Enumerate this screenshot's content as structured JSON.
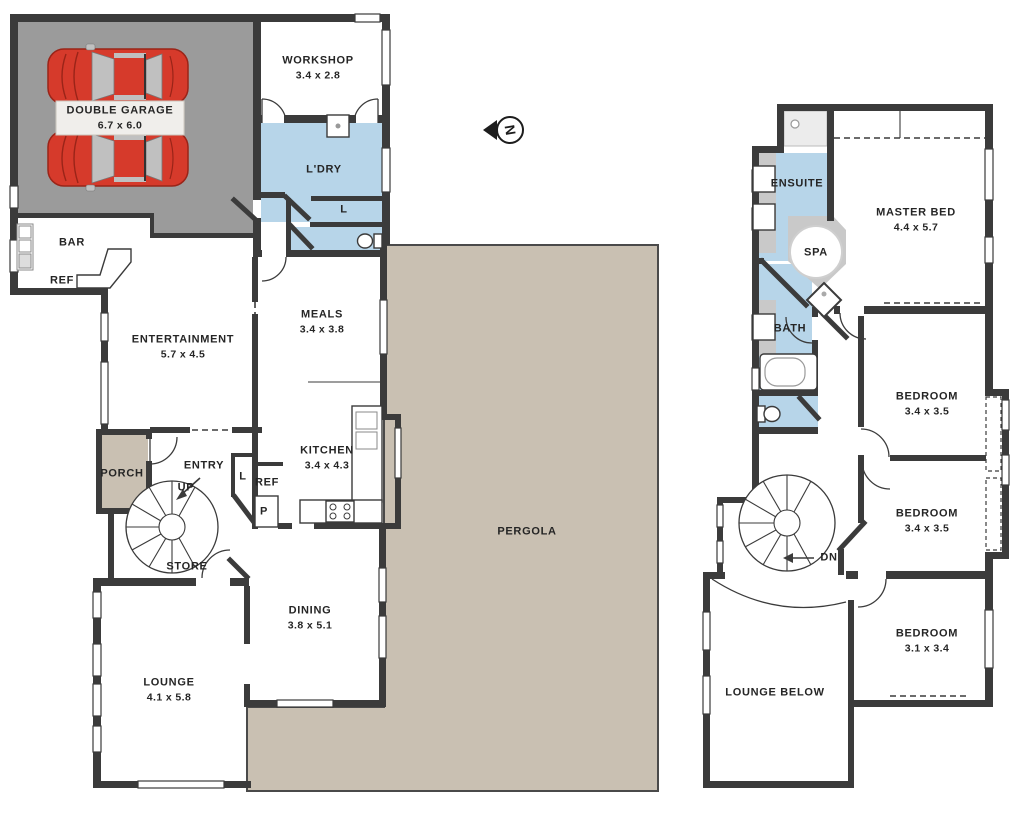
{
  "title": "Two storey house floor plan",
  "colors": {
    "wall": "#3b3b3b",
    "garage_floor": "#9b9b9b",
    "wet_area_blue": "#b7d5e9",
    "pergola_beige": "#c9c0b2",
    "spa_surround_gray": "#c9c9c9",
    "car_red": "#d63a2b",
    "label_text": "#252525"
  },
  "compass": {
    "label": "N",
    "icon": "north-arrow-icon"
  },
  "ground": {
    "rooms": [
      {
        "name": "DOUBLE GARAGE",
        "dims": "6.7 x 6.0"
      },
      {
        "name": "WORKSHOP",
        "dims": "3.4 x 2.8"
      },
      {
        "name": "L'DRY"
      },
      {
        "name": "L"
      },
      {
        "name": "BAR"
      },
      {
        "name": "REF"
      },
      {
        "name": "ENTERTAINMENT",
        "dims": "5.7 x 4.5"
      },
      {
        "name": "MEALS",
        "dims": "3.4 x 3.8"
      },
      {
        "name": "KITCHEN",
        "dims": "3.4 x 4.3"
      },
      {
        "name": "PORCH"
      },
      {
        "name": "ENTRY"
      },
      {
        "name": "UP"
      },
      {
        "name": "L"
      },
      {
        "name": "REF"
      },
      {
        "name": "P"
      },
      {
        "name": "STORE"
      },
      {
        "name": "DINING",
        "dims": "3.8 x 5.1"
      },
      {
        "name": "LOUNGE",
        "dims": "4.1 x 5.8"
      },
      {
        "name": "PERGOLA"
      }
    ]
  },
  "first": {
    "rooms": [
      {
        "name": "ENSUITE"
      },
      {
        "name": "SPA"
      },
      {
        "name": "MASTER BED",
        "dims": "4.4 x 5.7"
      },
      {
        "name": "BATH"
      },
      {
        "name": "DN"
      },
      {
        "name": "BEDROOM",
        "dims": "3.4 x 3.5"
      },
      {
        "name": "BEDROOM",
        "dims": "3.4 x 3.5"
      },
      {
        "name": "BEDROOM",
        "dims": "3.1 x 3.4"
      },
      {
        "name": "LOUNGE BELOW"
      }
    ]
  }
}
